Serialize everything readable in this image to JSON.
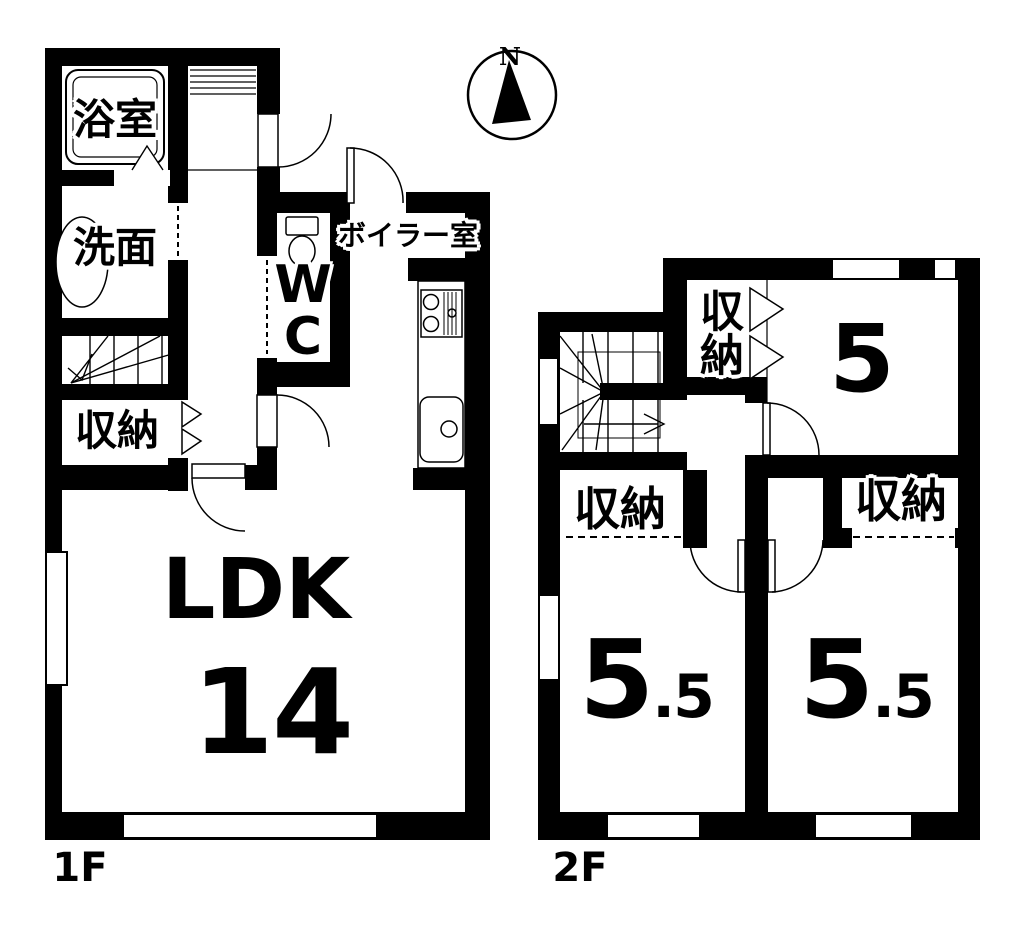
{
  "colors": {
    "wall": "#000000",
    "background": "#ffffff"
  },
  "compass": {
    "north_label": "N"
  },
  "floor_1": {
    "floor_label": "1F",
    "bath_label": "浴室",
    "washroom_label": "洗面",
    "storage_label": "収納",
    "wc_label": "W\nC",
    "boiler_label": "ボイラー室",
    "ldk_label": "LDK",
    "ldk_area": "14"
  },
  "floor_2": {
    "floor_label": "2F",
    "storage_top_label": "収納",
    "storage_left_label": "収納",
    "storage_right_label": "収納",
    "room5_area": "5",
    "room55_left": {
      "main": "5",
      "frac": ".5"
    },
    "room55_right": {
      "main": "5",
      "frac": ".5"
    }
  }
}
